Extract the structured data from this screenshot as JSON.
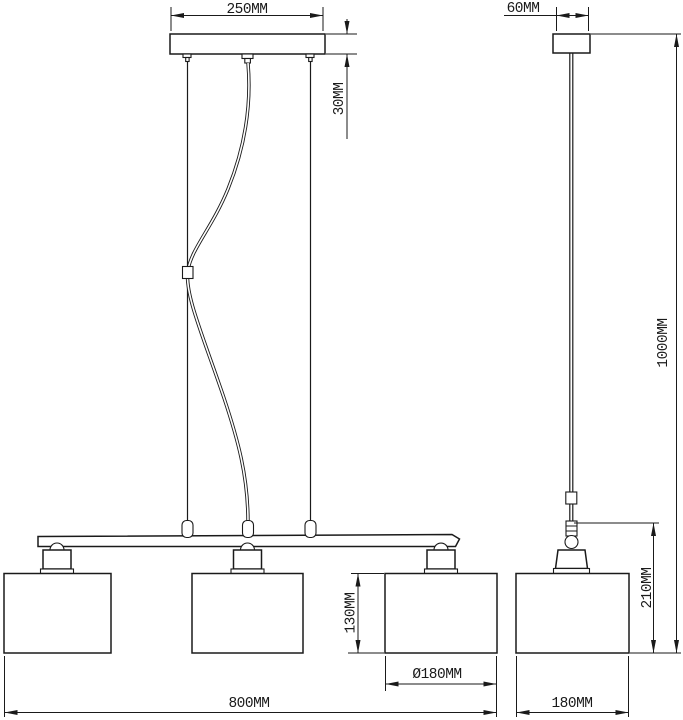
{
  "drawing": {
    "units": "MM",
    "colors": {
      "line": "#1a1a1a",
      "background": "#ffffff"
    },
    "front_view": {
      "canopy_width": "250MM",
      "canopy_height": "30MM",
      "shade_height": "130MM",
      "shade_diameter": "Ø180MM",
      "total_width": "800MM"
    },
    "side_view": {
      "canopy_depth": "60MM",
      "drop_height": "1000MM",
      "lamp_height": "210MM",
      "shade_depth": "180MM"
    }
  }
}
